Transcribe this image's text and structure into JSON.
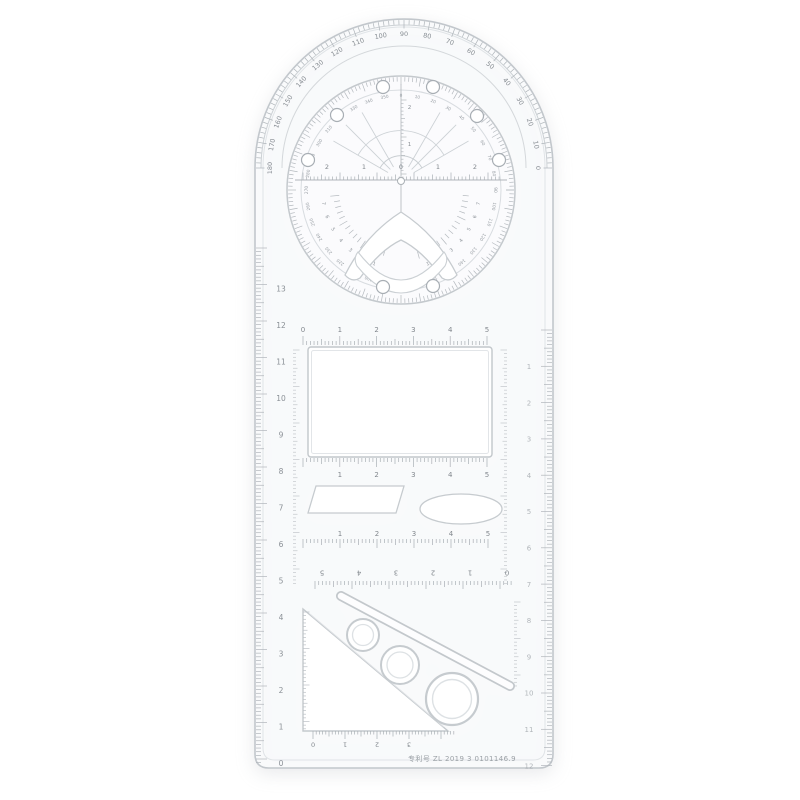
{
  "image": {
    "description": "Transparent multifunctional geometric drawing ruler with rotating protractor disc, rectangle / parallelogram / ellipse / triangle / circle stencil cutouts, photographed on a white background"
  },
  "ruler": {
    "patent_text": "专利号 ZL 2019 3 0101146.9",
    "protractor": {
      "outer_degree_labels": [
        "0",
        "10",
        "20",
        "30",
        "40",
        "50",
        "60",
        "70",
        "80",
        "90",
        "100",
        "110",
        "120",
        "130",
        "140",
        "150",
        "160",
        "170",
        "180"
      ],
      "disc_degree_labels": [
        "0",
        "10",
        "20",
        "30",
        "40",
        "50",
        "60",
        "70",
        "80",
        "90",
        "100",
        "110",
        "120",
        "130",
        "140",
        "150",
        "160",
        "170",
        "180",
        "190",
        "200",
        "210",
        "220",
        "230",
        "240",
        "250",
        "260",
        "270",
        "280",
        "290",
        "300",
        "310",
        "320",
        "330",
        "340",
        "350"
      ],
      "center_ruler_labels": [
        "2",
        "1",
        "0",
        "1",
        "2"
      ],
      "vertical_labels": [
        "1",
        "2"
      ],
      "fan_left_labels": [
        "7",
        "6",
        "5",
        "4",
        "3",
        "2",
        "1"
      ],
      "fan_right_labels": [
        "1",
        "2",
        "3",
        "4",
        "5",
        "6",
        "7"
      ]
    },
    "scales": {
      "left_edge_labels": [
        "0",
        "1",
        "2",
        "3",
        "4",
        "5",
        "6",
        "7",
        "8",
        "9",
        "10",
        "11",
        "12",
        "13"
      ],
      "right_edge_labels": [
        "1",
        "2",
        "3",
        "4",
        "5",
        "6",
        "7",
        "8",
        "9",
        "10",
        "11",
        "12"
      ],
      "window_top_labels": [
        "0",
        "1",
        "2",
        "3",
        "4",
        "5"
      ],
      "window_bottom_labels": [
        "1",
        "2",
        "3",
        "4",
        "5"
      ],
      "mid_row_labels": [
        "1",
        "2",
        "3",
        "4",
        "5"
      ],
      "reversed_row_labels": [
        "5",
        "4",
        "3",
        "2",
        "1",
        "0"
      ],
      "triangle_bottom_labels": [
        "0",
        "1",
        "2",
        "3"
      ]
    }
  }
}
